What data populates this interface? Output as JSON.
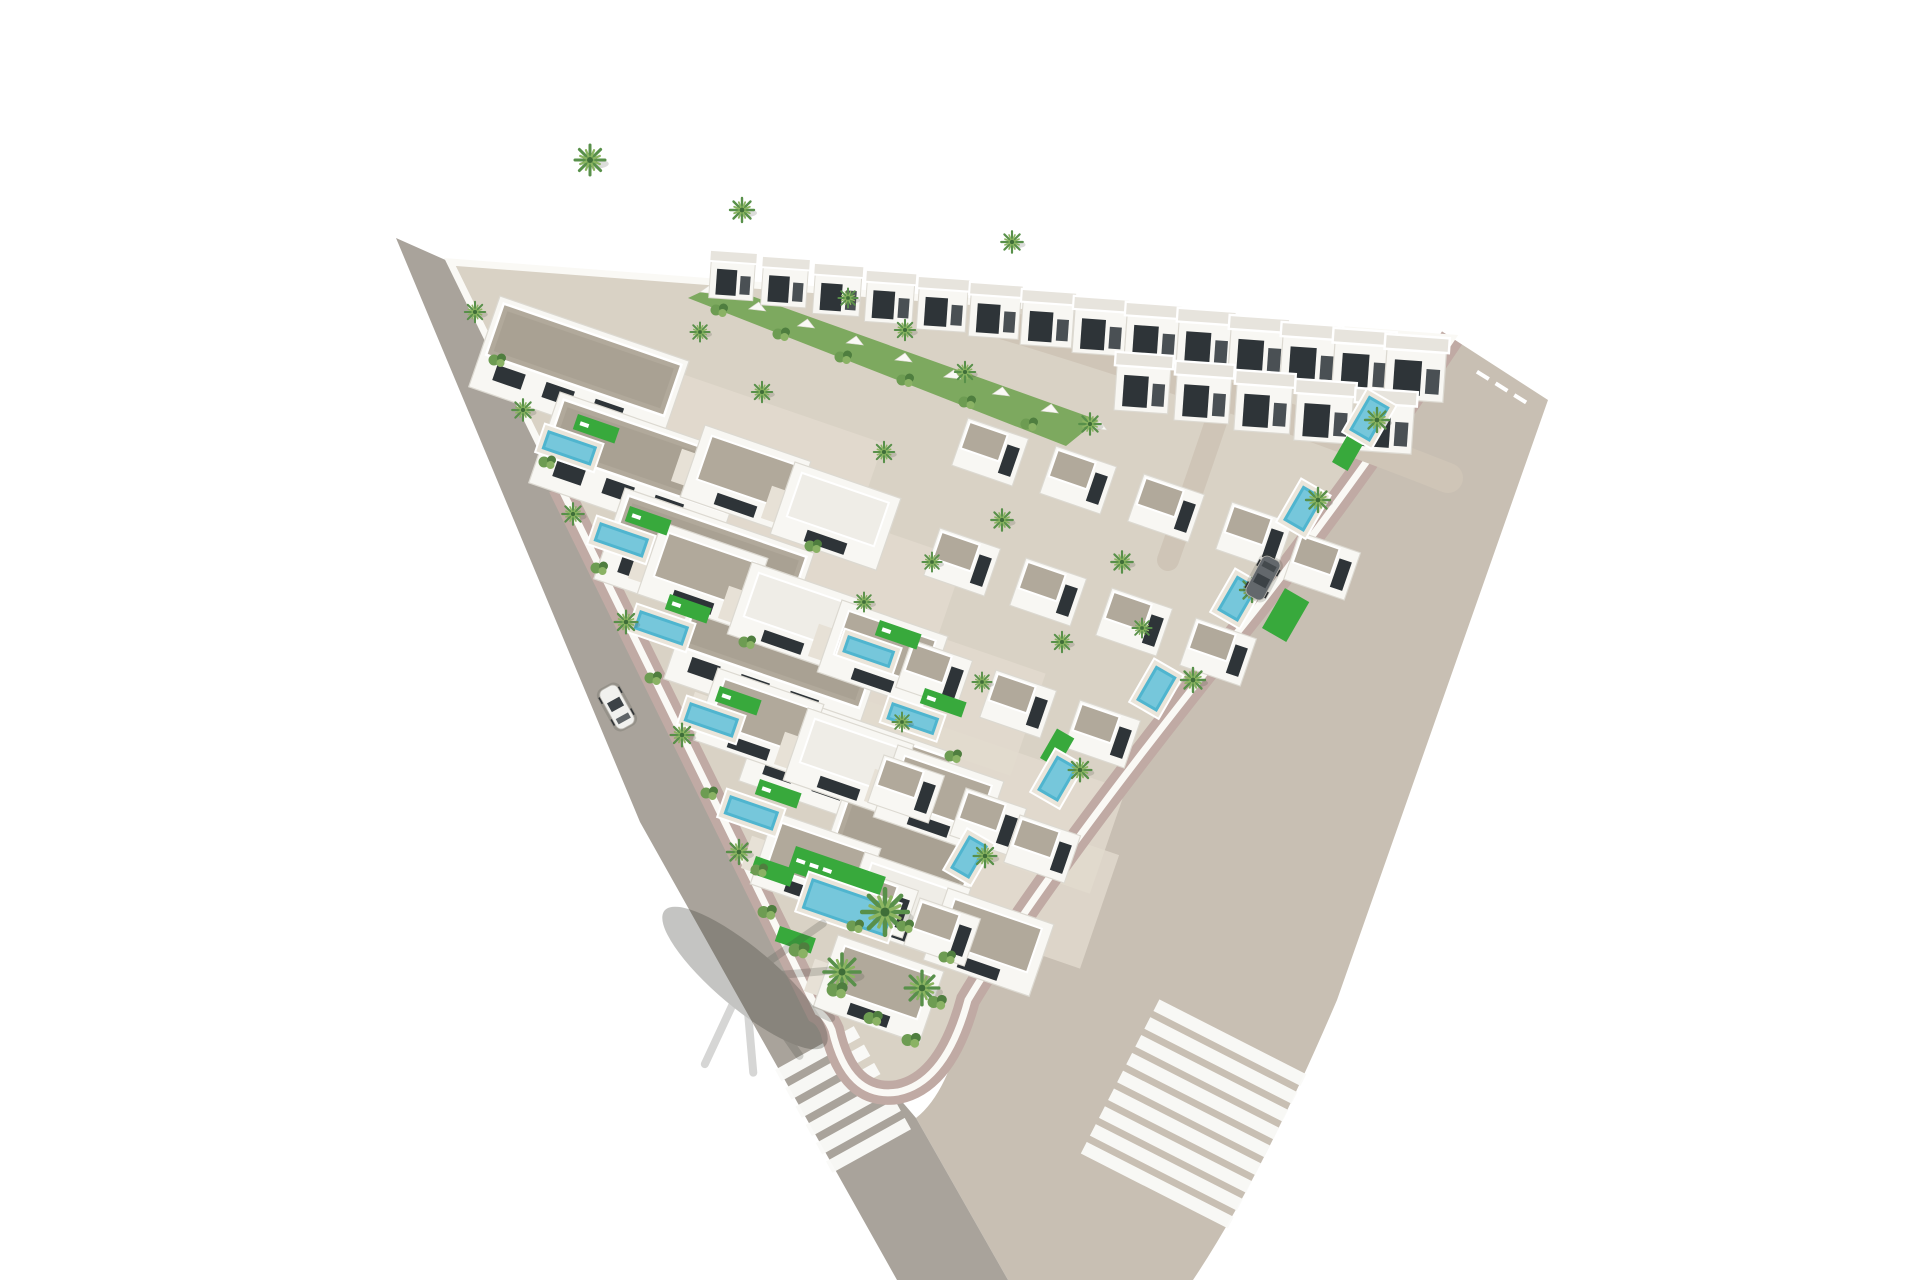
{
  "colors": {
    "background": "#ffffff",
    "road_left": "#a9a39b",
    "road_right": "#c8bfb3",
    "road_internal": "#cfc5b7",
    "sidewalk": "#c0aaa4",
    "curb": "#978e83",
    "wall": "#faf9f5",
    "plot_ground": "#d9d2c5",
    "ground_patch": "#e2dbce",
    "green_slope": "#7da95f",
    "roof_gravel": "#b1a99b",
    "roof_gravel_dark": "#a29a8c",
    "roof_top_row": "#e7e4dd",
    "roof_flat_white": "#efede7",
    "villa_white": "#f8f7f3",
    "villa_stroke": "#dcd9d1",
    "terrace": "#e7e1d6",
    "window_dark": "#2e3438",
    "window_side": "#4a5054",
    "pool_water": "#4fb5cf",
    "pool_light": "#a6dde9",
    "pool_deck": "#eae5da",
    "lawn_green": "#38a93c",
    "palm_dark": "#58904a",
    "palm_light": "#8cb561",
    "palm_core": "#3f6e38",
    "shrub_a": "#6d9c52",
    "shrub_b": "#4f7e3f",
    "shrub_c": "#8ab264",
    "shadow": "#3f4038",
    "car_white": "#f1f1ee",
    "car_dark": "#63686c",
    "glass": "#3c4246",
    "stripe_white": "#fafaf8",
    "wheel": "#2f3234"
  },
  "scene": {
    "top_row_villas": [
      {
        "x": 712,
        "y": 250,
        "s": 0.92
      },
      {
        "x": 764,
        "y": 256,
        "s": 0.94
      },
      {
        "x": 816,
        "y": 263,
        "s": 0.97
      },
      {
        "x": 868,
        "y": 270,
        "s": 0.99
      },
      {
        "x": 920,
        "y": 276,
        "s": 1.02
      },
      {
        "x": 972,
        "y": 282,
        "s": 1.04
      },
      {
        "x": 1024,
        "y": 289,
        "s": 1.07
      },
      {
        "x": 1076,
        "y": 296,
        "s": 1.09
      },
      {
        "x": 1128,
        "y": 302,
        "s": 1.12
      },
      {
        "x": 1180,
        "y": 308,
        "s": 1.14
      },
      {
        "x": 1232,
        "y": 315,
        "s": 1.17
      },
      {
        "x": 1284,
        "y": 322,
        "s": 1.19
      },
      {
        "x": 1336,
        "y": 328,
        "s": 1.22
      },
      {
        "x": 1388,
        "y": 334,
        "s": 1.24
      }
    ],
    "top_row2_villas": [
      {
        "x": 1118,
        "y": 352,
        "s": 1.12
      },
      {
        "x": 1178,
        "y": 361,
        "s": 1.14
      },
      {
        "x": 1238,
        "y": 370,
        "s": 1.16
      },
      {
        "x": 1298,
        "y": 379,
        "s": 1.18
      },
      {
        "x": 1358,
        "y": 388,
        "s": 1.2
      }
    ],
    "left_rows": [
      {
        "x": 500,
        "y": 296,
        "w": 200
      },
      {
        "x": 560,
        "y": 392,
        "w": 200
      },
      {
        "x": 625,
        "y": 488,
        "w": 200
      },
      {
        "x": 695,
        "y": 588,
        "w": 200
      },
      {
        "x": 770,
        "y": 690,
        "w": 200
      },
      {
        "x": 845,
        "y": 790,
        "w": 150
      }
    ],
    "middle_villas": [
      {
        "x": 705,
        "y": 425,
        "f": "g"
      },
      {
        "x": 795,
        "y": 462,
        "f": "w"
      },
      {
        "x": 662,
        "y": 522,
        "f": "g"
      },
      {
        "x": 752,
        "y": 562,
        "f": "w"
      },
      {
        "x": 842,
        "y": 600,
        "f": "g"
      },
      {
        "x": 718,
        "y": 668,
        "f": "g"
      },
      {
        "x": 808,
        "y": 708,
        "f": "w"
      },
      {
        "x": 898,
        "y": 745,
        "f": "g"
      },
      {
        "x": 775,
        "y": 812,
        "f": "g"
      },
      {
        "x": 865,
        "y": 852,
        "f": "w"
      },
      {
        "x": 948,
        "y": 888,
        "f": "g"
      },
      {
        "x": 838,
        "y": 935,
        "f": "g"
      }
    ],
    "right_villas": [
      {
        "x": 968,
        "y": 418
      },
      {
        "x": 1056,
        "y": 446
      },
      {
        "x": 1144,
        "y": 474
      },
      {
        "x": 1232,
        "y": 502
      },
      {
        "x": 1300,
        "y": 532
      },
      {
        "x": 940,
        "y": 528
      },
      {
        "x": 1026,
        "y": 558
      },
      {
        "x": 1112,
        "y": 588
      },
      {
        "x": 1196,
        "y": 618
      },
      {
        "x": 912,
        "y": 640
      },
      {
        "x": 996,
        "y": 670
      },
      {
        "x": 1080,
        "y": 700
      },
      {
        "x": 884,
        "y": 755
      },
      {
        "x": 966,
        "y": 788
      },
      {
        "x": 1020,
        "y": 815
      },
      {
        "x": 858,
        "y": 870
      },
      {
        "x": 920,
        "y": 898
      }
    ],
    "pools": [
      {
        "x": 548,
        "y": 430,
        "w": 52,
        "h": 20,
        "r": 19
      },
      {
        "x": 600,
        "y": 522,
        "w": 52,
        "h": 20,
        "r": 19
      },
      {
        "x": 640,
        "y": 610,
        "w": 52,
        "h": 20,
        "r": 19
      },
      {
        "x": 690,
        "y": 702,
        "w": 52,
        "h": 20,
        "r": 19
      },
      {
        "x": 730,
        "y": 795,
        "w": 52,
        "h": 20,
        "r": 19
      },
      {
        "x": 848,
        "y": 635,
        "w": 50,
        "h": 18,
        "r": 19
      },
      {
        "x": 892,
        "y": 702,
        "w": 50,
        "h": 18,
        "r": 19
      },
      {
        "x": 812,
        "y": 878,
        "w": 88,
        "h": 32,
        "r": 19
      },
      {
        "x": 1349,
        "y": 430,
        "w": 40,
        "h": 24,
        "r": -60
      },
      {
        "x": 1283,
        "y": 520,
        "w": 40,
        "h": 24,
        "r": -60
      },
      {
        "x": 1217,
        "y": 610,
        "w": 40,
        "h": 24,
        "r": -60
      },
      {
        "x": 1136,
        "y": 700,
        "w": 40,
        "h": 24,
        "r": -60
      },
      {
        "x": 1037,
        "y": 790,
        "w": 40,
        "h": 24,
        "r": -60
      },
      {
        "x": 950,
        "y": 868,
        "w": 38,
        "h": 22,
        "r": -60
      }
    ],
    "lawns": [
      {
        "x": 578,
        "y": 414,
        "w": 44,
        "h": 16,
        "r": 19,
        "n": 1
      },
      {
        "x": 630,
        "y": 506,
        "w": 44,
        "h": 16,
        "r": 19,
        "n": 1
      },
      {
        "x": 670,
        "y": 594,
        "w": 44,
        "h": 16,
        "r": 19,
        "n": 1
      },
      {
        "x": 720,
        "y": 686,
        "w": 44,
        "h": 16,
        "r": 19,
        "n": 1
      },
      {
        "x": 760,
        "y": 779,
        "w": 44,
        "h": 16,
        "r": 19,
        "n": 1
      },
      {
        "x": 880,
        "y": 620,
        "w": 44,
        "h": 16,
        "r": 19,
        "n": 1
      },
      {
        "x": 925,
        "y": 688,
        "w": 44,
        "h": 16,
        "r": 19,
        "n": 1
      },
      {
        "x": 756,
        "y": 856,
        "w": 42,
        "h": 18,
        "r": 19,
        "n": 0
      },
      {
        "x": 780,
        "y": 926,
        "w": 38,
        "h": 16,
        "r": 19,
        "n": 0
      },
      {
        "x": 796,
        "y": 846,
        "w": 95,
        "h": 26,
        "r": 19,
        "n": 3
      },
      {
        "x": 1262,
        "y": 628,
        "w": 46,
        "h": 28,
        "r": -60,
        "n": 0
      },
      {
        "x": 1040,
        "y": 758,
        "w": 34,
        "h": 20,
        "r": -60,
        "n": 0
      },
      {
        "x": 1332,
        "y": 462,
        "w": 30,
        "h": 18,
        "r": -60,
        "n": 0
      }
    ],
    "ground_patches": [
      {
        "x": 630,
        "y": 356,
        "w": 268,
        "h": 92
      },
      {
        "x": 694,
        "y": 466,
        "w": 286,
        "h": 100
      },
      {
        "x": 762,
        "y": 576,
        "w": 300,
        "h": 108
      },
      {
        "x": 842,
        "y": 692,
        "w": 300,
        "h": 110
      },
      {
        "x": 930,
        "y": 790,
        "w": 200,
        "h": 120
      }
    ],
    "palms": [
      {
        "x": 475,
        "y": 312,
        "s": 0.85
      },
      {
        "x": 523,
        "y": 410,
        "s": 0.9
      },
      {
        "x": 573,
        "y": 514,
        "s": 0.9
      },
      {
        "x": 626,
        "y": 622,
        "s": 0.95
      },
      {
        "x": 682,
        "y": 735,
        "s": 0.95
      },
      {
        "x": 739,
        "y": 852,
        "s": 1.0
      },
      {
        "x": 590,
        "y": 160,
        "s": 1.25
      },
      {
        "x": 742,
        "y": 210,
        "s": 1.0
      },
      {
        "x": 1012,
        "y": 242,
        "s": 0.9
      },
      {
        "x": 848,
        "y": 298,
        "s": 0.8
      },
      {
        "x": 905,
        "y": 330,
        "s": 0.85
      },
      {
        "x": 965,
        "y": 372,
        "s": 0.85
      },
      {
        "x": 1090,
        "y": 424,
        "s": 0.9
      },
      {
        "x": 762,
        "y": 392,
        "s": 0.85
      },
      {
        "x": 700,
        "y": 332,
        "s": 0.8
      },
      {
        "x": 884,
        "y": 452,
        "s": 0.85
      },
      {
        "x": 1002,
        "y": 520,
        "s": 0.9
      },
      {
        "x": 1122,
        "y": 562,
        "s": 0.9
      },
      {
        "x": 932,
        "y": 562,
        "s": 0.8
      },
      {
        "x": 864,
        "y": 602,
        "s": 0.8
      },
      {
        "x": 1062,
        "y": 642,
        "s": 0.85
      },
      {
        "x": 982,
        "y": 682,
        "s": 0.8
      },
      {
        "x": 902,
        "y": 722,
        "s": 0.8
      },
      {
        "x": 1142,
        "y": 628,
        "s": 0.8
      },
      {
        "x": 1377,
        "y": 420,
        "s": 1.0
      },
      {
        "x": 1318,
        "y": 500,
        "s": 1.0
      },
      {
        "x": 1252,
        "y": 590,
        "s": 1.0
      },
      {
        "x": 1193,
        "y": 680,
        "s": 1.0
      },
      {
        "x": 1080,
        "y": 770,
        "s": 0.95
      },
      {
        "x": 985,
        "y": 856,
        "s": 0.95
      },
      {
        "x": 885,
        "y": 912,
        "s": 1.9
      },
      {
        "x": 842,
        "y": 972,
        "s": 1.5
      },
      {
        "x": 922,
        "y": 988,
        "s": 1.4
      }
    ],
    "shrubs": [
      {
        "x": 498,
        "y": 360,
        "s": 1
      },
      {
        "x": 548,
        "y": 462,
        "s": 1
      },
      {
        "x": 600,
        "y": 568,
        "s": 1
      },
      {
        "x": 654,
        "y": 678,
        "s": 1
      },
      {
        "x": 710,
        "y": 793,
        "s": 1
      },
      {
        "x": 768,
        "y": 912,
        "s": 1.1
      },
      {
        "x": 720,
        "y": 310,
        "s": 1
      },
      {
        "x": 782,
        "y": 334,
        "s": 1
      },
      {
        "x": 844,
        "y": 357,
        "s": 1
      },
      {
        "x": 906,
        "y": 380,
        "s": 1
      },
      {
        "x": 968,
        "y": 402,
        "s": 1
      },
      {
        "x": 1030,
        "y": 424,
        "s": 1
      },
      {
        "x": 800,
        "y": 950,
        "s": 1.2
      },
      {
        "x": 838,
        "y": 990,
        "s": 1.2
      },
      {
        "x": 874,
        "y": 1018,
        "s": 1.1
      },
      {
        "x": 912,
        "y": 1040,
        "s": 1.1
      },
      {
        "x": 938,
        "y": 1002,
        "s": 1.1
      },
      {
        "x": 948,
        "y": 957,
        "s": 1
      },
      {
        "x": 906,
        "y": 926,
        "s": 1
      },
      {
        "x": 856,
        "y": 926,
        "s": 1
      },
      {
        "x": 814,
        "y": 546,
        "s": 1
      },
      {
        "x": 748,
        "y": 642,
        "s": 1
      },
      {
        "x": 954,
        "y": 756,
        "s": 1
      },
      {
        "x": 760,
        "y": 870,
        "s": 1
      }
    ],
    "crosswalks": [
      {
        "x": 845,
        "y": 1103,
        "rot": -29,
        "bars": 6,
        "len": 90,
        "bw": 13,
        "gap": 21
      },
      {
        "x": 1192,
        "y": 1117,
        "rot": 27,
        "bars": 9,
        "len": 165,
        "bw": 13,
        "gap": 20
      }
    ],
    "cars": [
      {
        "x": 617,
        "y": 707,
        "rot": 61,
        "c": "car_white"
      },
      {
        "x": 1263,
        "y": 578,
        "rot": -62,
        "c": "car_dark"
      }
    ],
    "wall_teeth": {
      "x1": 700,
      "y1": 292,
      "x2": 1090,
      "y2": 428,
      "count": 9
    },
    "entrance_dashes": {
      "x": 1478,
      "y": 370,
      "rot": 32,
      "count": 3
    },
    "palm_shadow": {
      "x": 745,
      "y": 978,
      "rot": 40
    }
  }
}
